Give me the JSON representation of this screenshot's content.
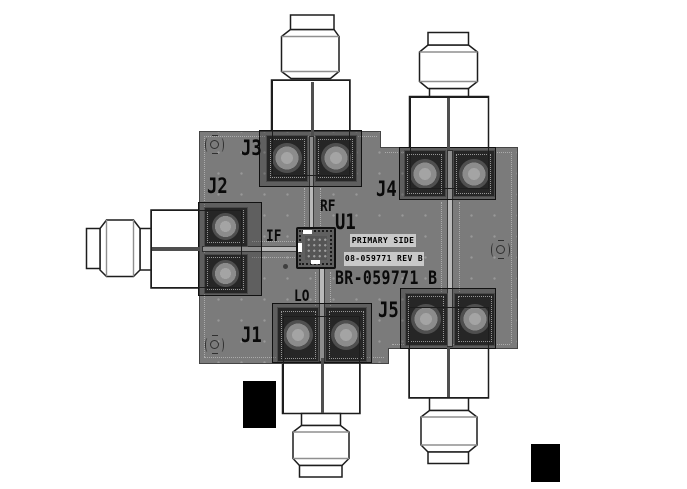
{
  "board": {
    "name": "BR-059771 B",
    "side": "PRIMARY SIDE",
    "pcb_id": "08-059771 REV B",
    "ic_ref": "U1",
    "connector_refs": {
      "j1": "J1",
      "j2": "J2",
      "j3": "J3",
      "j4": "J4",
      "j5": "J5"
    },
    "signal_labels": {
      "rf": "RF",
      "if": "IF",
      "lo": "LO"
    },
    "colors": {
      "background": "#ffffff",
      "board": "#7b7b7b",
      "pad": "#262626",
      "pad_ring": "#8c8c8c",
      "trace": "#b9b9b9",
      "silkscreen": "#000000",
      "label_plate": "#c9c9c9",
      "connector_fill": "#ffffff",
      "connector_outline": "#1d1d1d",
      "marker": "#000000"
    }
  }
}
